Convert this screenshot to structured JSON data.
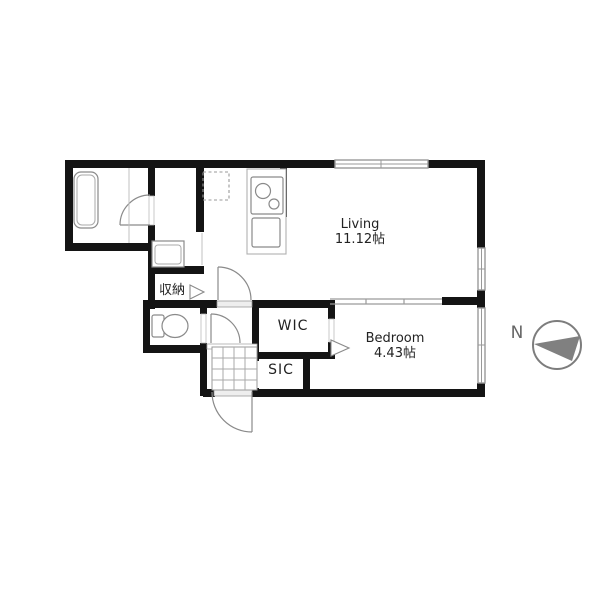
{
  "plan": {
    "type": "apartment-floor-plan",
    "rooms": {
      "living": {
        "name": "Living",
        "size": "11.12帖"
      },
      "bedroom": {
        "name": "Bedroom",
        "size": "4.43帖"
      },
      "wic": {
        "label": "WIC"
      },
      "sic": {
        "label": "SIC"
      },
      "storage": {
        "label": "収納"
      }
    },
    "compass": {
      "north_label": "N"
    },
    "fixtures": [
      "bathtub",
      "washing-machine-pan",
      "refrigerator-space",
      "gas-stove-2-burner",
      "kitchen-sink",
      "toilet",
      "entrance-tile-floor",
      "hinged-door-swing",
      "sliding-partition",
      "window",
      "opening-direction-triangle",
      "north-arrow"
    ],
    "colors": {
      "wall": "#141414",
      "fixture_outline": "#8a8a8a",
      "window_outline": "#999999",
      "sliding_door": "#9a9a9a",
      "tile_grid": "#aaaaaa",
      "compass_gray": "#7d7d7d",
      "text": "#222222",
      "background": "#ffffff"
    }
  }
}
